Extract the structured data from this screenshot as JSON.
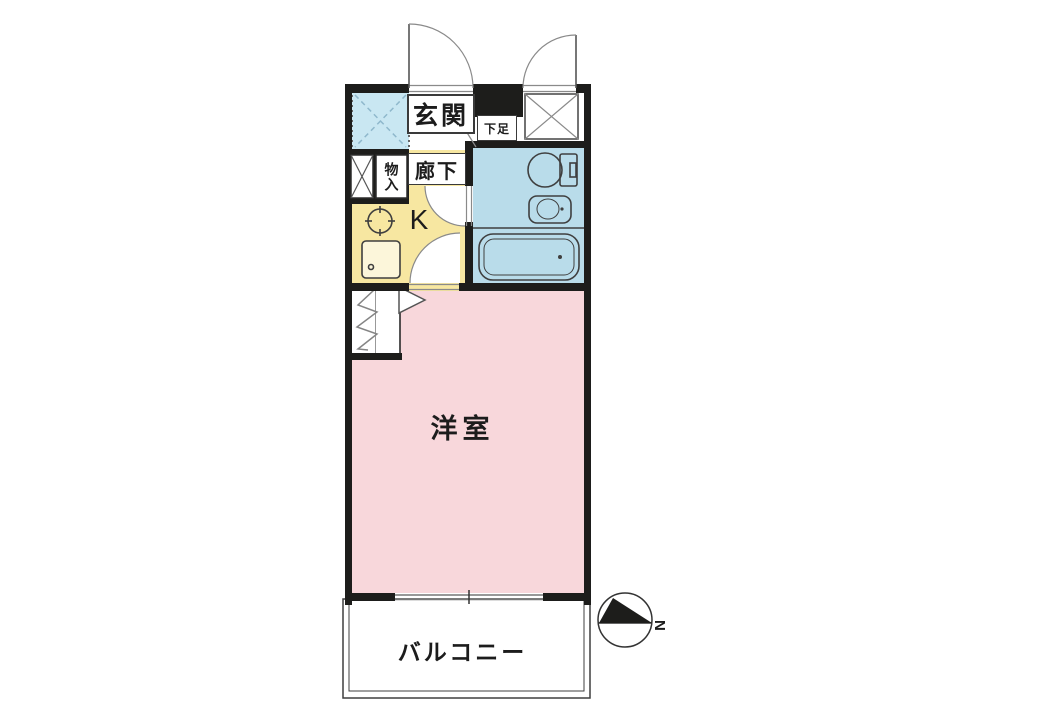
{
  "page": {
    "type": "apartment-floor-plan",
    "background": "#ffffff"
  },
  "floor_plan": {
    "rooms": {
      "entrance": "玄関",
      "shoe_cabinet": "下足",
      "storage": "物入",
      "hallway": "廊下",
      "kitchen": "K",
      "western_room": "洋室",
      "balcony": "バルコニー"
    },
    "compass": {
      "north": "N"
    },
    "colors": {
      "wall": "#1d1d1b",
      "western-room": "#f8d7db",
      "kitchen-yellow": "#f7e7a1",
      "bathroom-blue": "#b9dcea",
      "void-blue": "#c9e7f2",
      "fixture-line": "#3f3f3f",
      "thin-line": "#8a8a8a"
    },
    "icons": [
      "toilet-icon",
      "washbasin-icon",
      "bathtub-icon",
      "stove-icon",
      "kitchen-sink-icon",
      "closet-hanger-icon",
      "door-swing-icon",
      "north-arrow-icon",
      "crossed-box-icon",
      "void-hatch-icon"
    ]
  }
}
